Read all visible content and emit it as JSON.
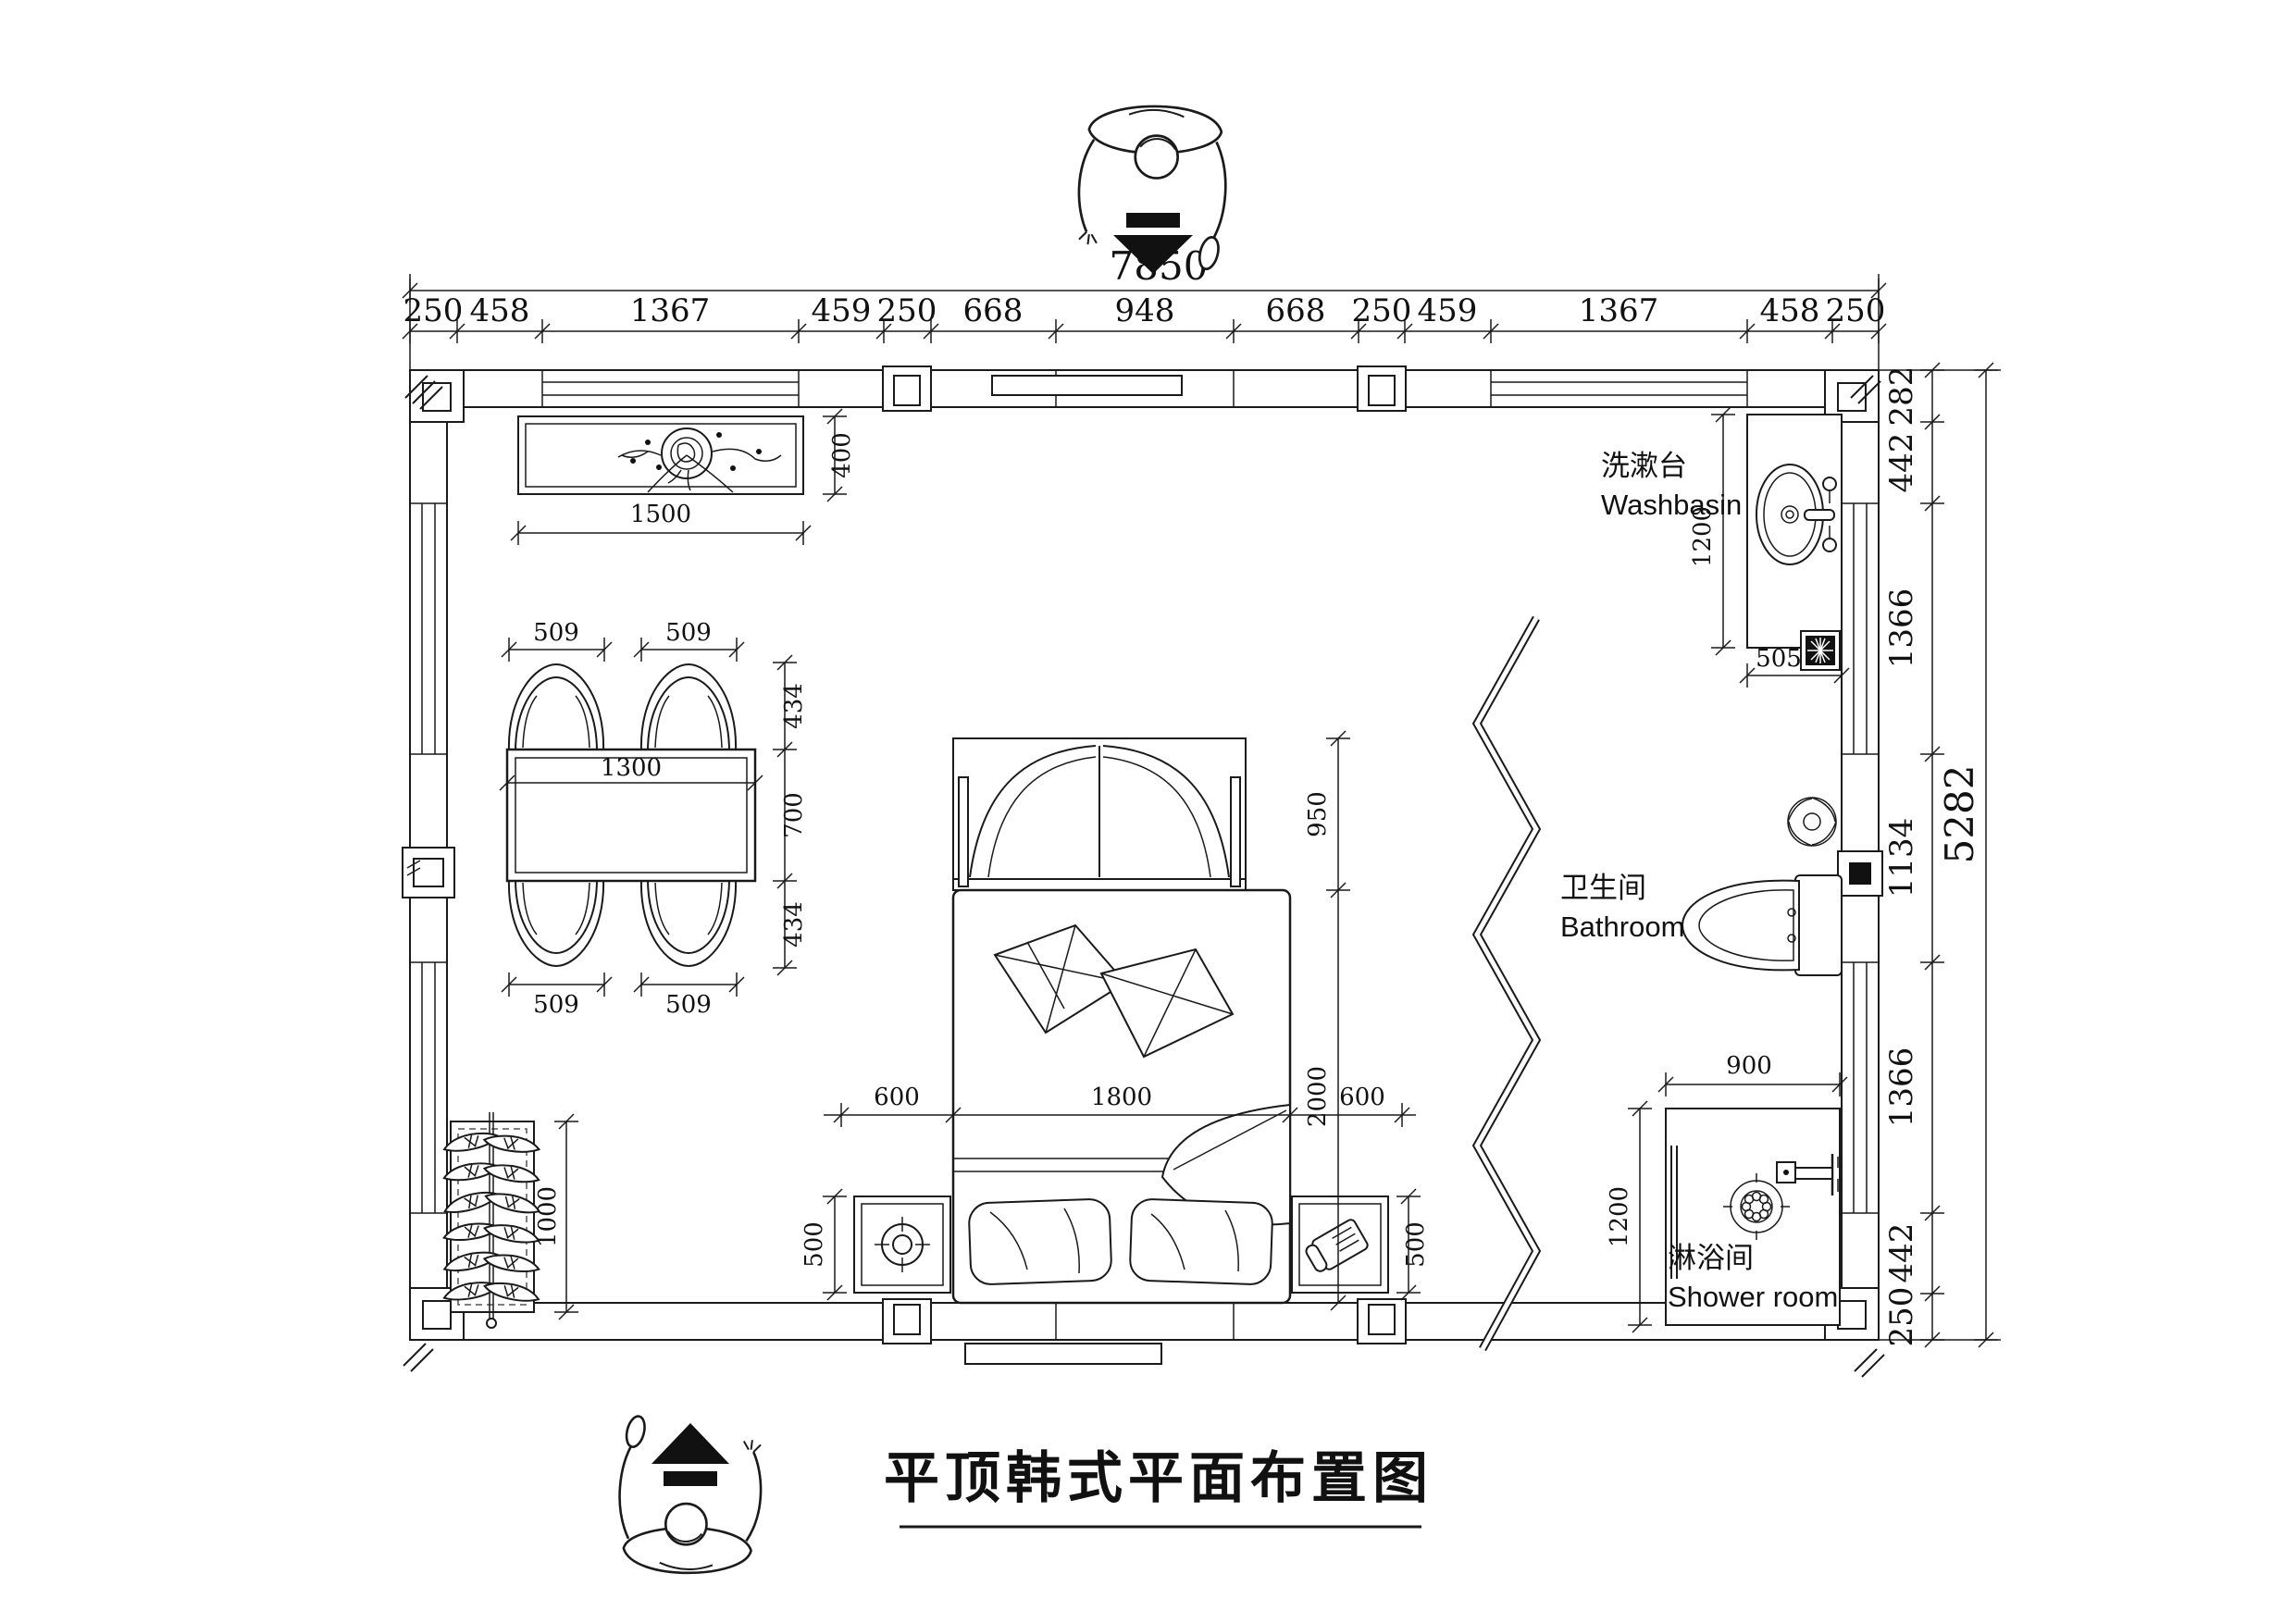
{
  "doc": {
    "title": "平顶韩式平面布置图"
  },
  "dimensions": {
    "overall": {
      "width": "7850",
      "height": "5282"
    },
    "top_chain": [
      "250",
      "458",
      "1367",
      "459",
      "250",
      "668",
      "948",
      "668",
      "250",
      "459",
      "1367",
      "458",
      "250"
    ],
    "right_chain": [
      "282",
      "442",
      "1366",
      "1134",
      "1366",
      "442",
      "250"
    ]
  },
  "labels": {
    "washbasin": {
      "zh": "洗漱台",
      "en": "Washbasin"
    },
    "bathroom": {
      "zh": "卫生间",
      "en": "Bathroom"
    },
    "shower_room": {
      "zh": "淋浴间",
      "en": "Shower room"
    }
  },
  "furniture": {
    "console": {
      "width": "1500",
      "depth": "400"
    },
    "dining": {
      "chairs": [
        "509",
        "509",
        "509",
        "509"
      ],
      "table_length": "1300",
      "right_chain": [
        "434",
        "700",
        "434"
      ]
    },
    "bed": {
      "left_offset": "600",
      "width": "1800",
      "right_offset": "600",
      "length": "2000",
      "bay_depth": "950"
    },
    "nightstands": {
      "left": "500",
      "right": "500"
    },
    "shoe_cabinet": {
      "length": "1000"
    },
    "washbasin_counter": {
      "length": "1200",
      "width": "505"
    },
    "shower": {
      "width": "900",
      "length": "1200"
    }
  }
}
